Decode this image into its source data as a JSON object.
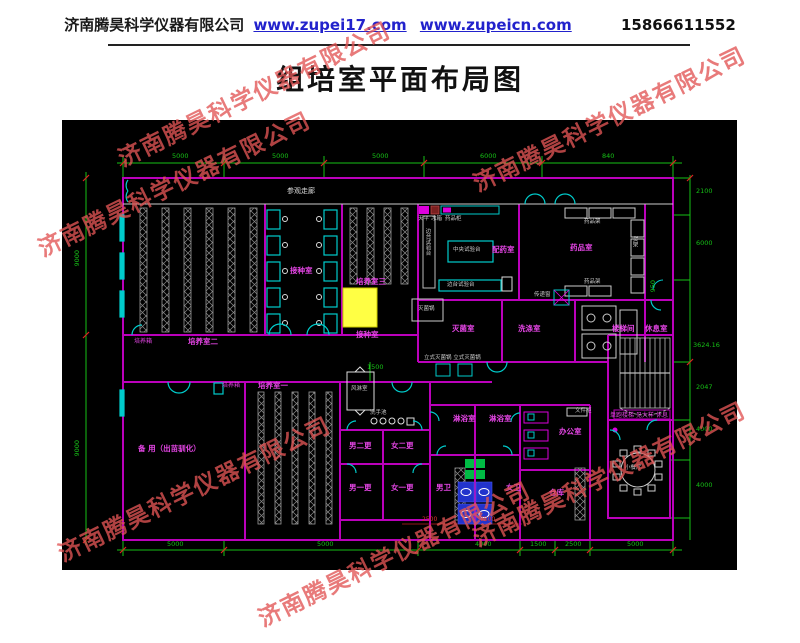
{
  "header": {
    "company": "济南腾昊科学仪器有限公司",
    "url1": "www.zupei17.com",
    "url2": "www.zupeicn.com",
    "phone": "15866611552"
  },
  "title": "组培室平面布局图",
  "watermark": {
    "text": "济南腾昊科学仪器有限公司",
    "color": "#e15555"
  },
  "plan": {
    "colors": {
      "background": "#000000",
      "wall": "#bb00bb",
      "room_label": "#e545e5",
      "dimension": "#16c016",
      "tick": "#dd2222",
      "door_bench": "#00cccc",
      "equipment": "#cccccc",
      "highlight": "#ffff44",
      "fixture_green": "#00bb44",
      "fixture_blue": "#2233cc"
    },
    "labels": [
      {
        "t": "参观走廊",
        "x": 225,
        "y": 68,
        "cls": "w"
      },
      {
        "t": "培养室二",
        "x": 126,
        "y": 218,
        "cls": "m"
      },
      {
        "t": "培养箱",
        "x": 72,
        "y": 219,
        "cls": "m6"
      },
      {
        "t": "接种室",
        "x": 228,
        "y": 147,
        "cls": "m"
      },
      {
        "t": "培养室三",
        "x": 294,
        "y": 158,
        "cls": "m"
      },
      {
        "t": "接种室",
        "x": 294,
        "y": 211,
        "cls": "m"
      },
      {
        "t": "配药室",
        "x": 430,
        "y": 126,
        "cls": "m"
      },
      {
        "t": "药品室",
        "x": 508,
        "y": 124,
        "cls": "m"
      },
      {
        "t": "灭菌室",
        "x": 390,
        "y": 205,
        "cls": "m"
      },
      {
        "t": "洗涤室",
        "x": 456,
        "y": 205,
        "cls": "m"
      },
      {
        "t": "楼梯间",
        "x": 550,
        "y": 205,
        "cls": "m"
      },
      {
        "t": "休息室",
        "x": 583,
        "y": 205,
        "cls": "m"
      },
      {
        "t": "培养室一",
        "x": 196,
        "y": 262,
        "cls": "m"
      },
      {
        "t": "培养箱",
        "x": 160,
        "y": 263,
        "cls": "m6"
      },
      {
        "t": "备 用（出苗驯化）",
        "x": 76,
        "y": 325,
        "cls": "m"
      },
      {
        "t": "男二更",
        "x": 287,
        "y": 322,
        "cls": "m"
      },
      {
        "t": "女二更",
        "x": 329,
        "y": 322,
        "cls": "m"
      },
      {
        "t": "男一更",
        "x": 287,
        "y": 364,
        "cls": "m"
      },
      {
        "t": "女一更",
        "x": 329,
        "y": 364,
        "cls": "m"
      },
      {
        "t": "淋浴室",
        "x": 391,
        "y": 295,
        "cls": "m"
      },
      {
        "t": "淋浴室",
        "x": 427,
        "y": 295,
        "cls": "m"
      },
      {
        "t": "男卫",
        "x": 374,
        "y": 364,
        "cls": "m"
      },
      {
        "t": "女卫",
        "x": 444,
        "y": 364,
        "cls": "m"
      },
      {
        "t": "办公室",
        "x": 497,
        "y": 308,
        "cls": "m"
      },
      {
        "t": "仓库",
        "x": 487,
        "y": 369,
        "cls": "m"
      },
      {
        "t": "单跑楼梯 见大样 休息",
        "x": 548,
        "y": 293,
        "cls": "m6"
      },
      {
        "t": "中央试验台",
        "x": 391,
        "y": 128,
        "cls": "w6"
      },
      {
        "t": "边台试验台",
        "x": 362,
        "y": 108,
        "cls": "wv"
      },
      {
        "t": "边台试验台",
        "x": 385,
        "y": 163,
        "cls": "w6"
      },
      {
        "t": "天平",
        "x": 356,
        "y": 97,
        "cls": "w6"
      },
      {
        "t": "冰箱",
        "x": 369,
        "y": 97,
        "cls": "w6"
      },
      {
        "t": "药品柜",
        "x": 383,
        "y": 97,
        "cls": "w6"
      },
      {
        "t": "灭菌锅",
        "x": 356,
        "y": 187,
        "cls": "w6"
      },
      {
        "t": "传递窗",
        "x": 472,
        "y": 173,
        "cls": "w6"
      },
      {
        "t": "药品架",
        "x": 522,
        "y": 100,
        "cls": "w6"
      },
      {
        "t": "药品架",
        "x": 522,
        "y": 160,
        "cls": "w6"
      },
      {
        "t": "货架",
        "x": 569,
        "y": 116,
        "cls": "wv"
      },
      {
        "t": "立式灭菌锅 立式灭菌锅",
        "x": 362,
        "y": 236,
        "cls": "w6"
      },
      {
        "t": "风淋室",
        "x": 289,
        "y": 267,
        "cls": "w6"
      },
      {
        "t": "洗手池",
        "x": 308,
        "y": 291,
        "cls": "w6"
      },
      {
        "t": "文件柜",
        "x": 513,
        "y": 289,
        "cls": "w6"
      },
      {
        "t": "小餐厅",
        "x": 563,
        "y": 346,
        "cls": "w6"
      },
      {
        "t": "5000",
        "x": 110,
        "y": 33,
        "cls": "g"
      },
      {
        "t": "5000",
        "x": 210,
        "y": 33,
        "cls": "g"
      },
      {
        "t": "5000",
        "x": 310,
        "y": 33,
        "cls": "g"
      },
      {
        "t": "6000",
        "x": 418,
        "y": 33,
        "cls": "g"
      },
      {
        "t": "840",
        "x": 540,
        "y": 33,
        "cls": "g"
      },
      {
        "t": "9000",
        "x": 12,
        "y": 130,
        "cls": "gv"
      },
      {
        "t": "9000",
        "x": 12,
        "y": 320,
        "cls": "gv"
      },
      {
        "t": "2100",
        "x": 634,
        "y": 68,
        "cls": "g"
      },
      {
        "t": "6000",
        "x": 634,
        "y": 120,
        "cls": "g"
      },
      {
        "t": "950",
        "x": 588,
        "y": 160,
        "cls": "gv"
      },
      {
        "t": "3624.16",
        "x": 631,
        "y": 222,
        "cls": "g"
      },
      {
        "t": "2047",
        "x": 634,
        "y": 264,
        "cls": "g"
      },
      {
        "t": "4000",
        "x": 634,
        "y": 306,
        "cls": "g"
      },
      {
        "t": "4000",
        "x": 634,
        "y": 362,
        "cls": "g"
      },
      {
        "t": "1500",
        "x": 305,
        "y": 244,
        "cls": "g"
      },
      {
        "t": "5000",
        "x": 105,
        "y": 421,
        "cls": "g"
      },
      {
        "t": "5000",
        "x": 255,
        "y": 421,
        "cls": "g"
      },
      {
        "t": "4000",
        "x": 413,
        "y": 421,
        "cls": "g"
      },
      {
        "t": "1500",
        "x": 468,
        "y": 421,
        "cls": "g"
      },
      {
        "t": "2500",
        "x": 503,
        "y": 421,
        "cls": "g"
      },
      {
        "t": "5000",
        "x": 565,
        "y": 421,
        "cls": "g"
      },
      {
        "t": "2500",
        "x": 360,
        "y": 397,
        "cls": "r"
      },
      {
        "t": "7500",
        "x": 418,
        "y": 397,
        "cls": "r"
      }
    ]
  }
}
